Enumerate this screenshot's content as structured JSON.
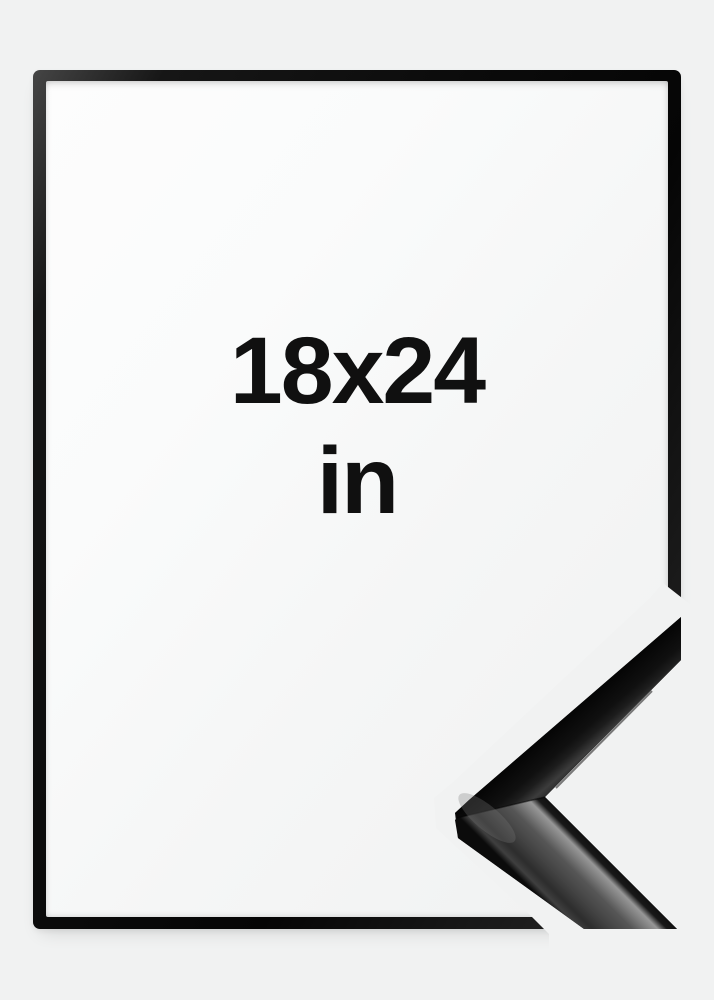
{
  "product": {
    "size_label": {
      "line1": "18x24",
      "line2": "in"
    }
  },
  "colors": {
    "page_background": "#f1f2f2",
    "frame_black": "#0d0d0d",
    "frame_opening_white": "#fbfcfc",
    "label_text": "#101010",
    "moulding_dark": "#141414",
    "moulding_highlight": "#979797"
  }
}
